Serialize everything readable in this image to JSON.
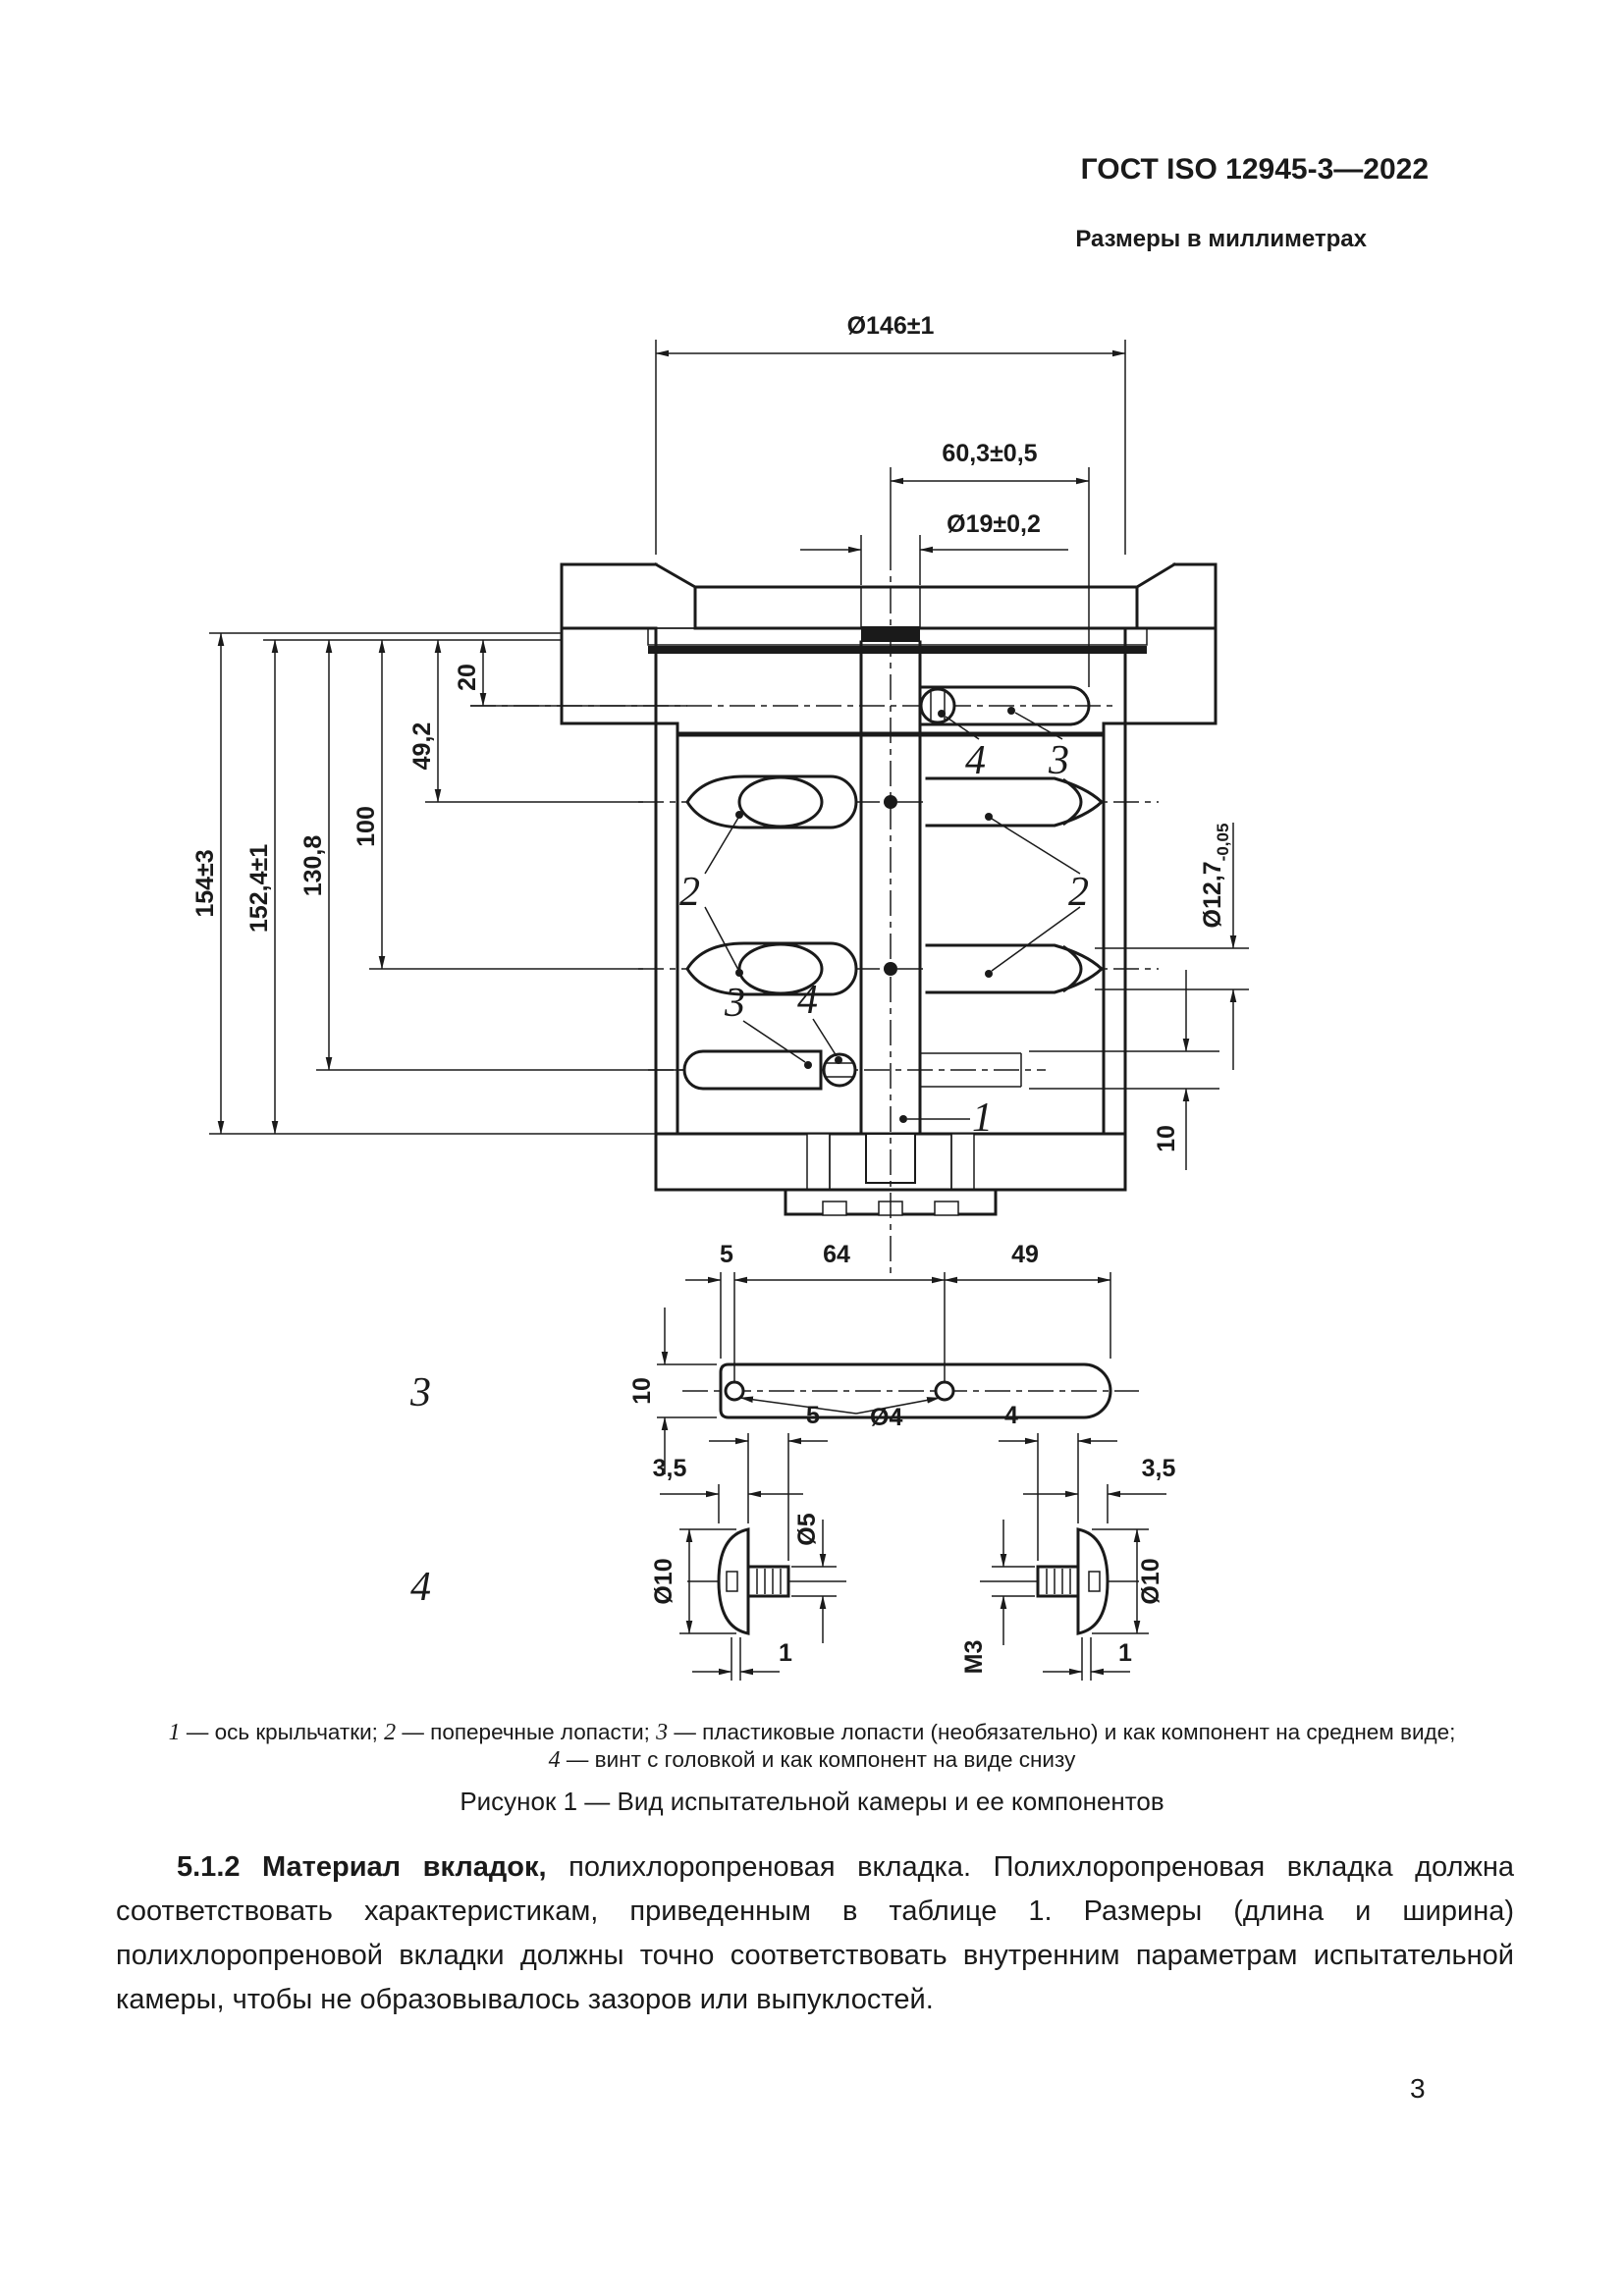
{
  "page": {
    "standard_code": "ГОСТ ISO 12945-3—2022",
    "units_note": "Размеры в миллиметрах",
    "page_number": "3"
  },
  "figure": {
    "caption": "Рисунок 1 — Вид испытательной камеры и ее компонентов",
    "legend": {
      "ref1": "1",
      "desc1": " — ось крыльчатки; ",
      "ref2": "2",
      "desc2": " — поперечные лопасти; ",
      "ref3": "3",
      "desc3": " — пластиковые лопасти (необязательно) и как компонент на среднем виде;",
      "ref4": "4",
      "desc4": " — винт с головкой и как компонент на виде снизу"
    },
    "main_view": {
      "dim_outer_diameter": "Ø146±1",
      "dim_blade_span": "60,3±0,5",
      "dim_shaft_hole": "Ø19±0,2",
      "dim_total_height": "154±3",
      "dim_inner_height": "152,4±1",
      "dim_lower_blade_height": "130,8",
      "dim_mid_blade_height": "100",
      "dim_upper_blade_height": "49,2",
      "dim_top_blade_offset": "20",
      "dim_shaft_dia": "Ø12,7",
      "dim_shaft_dia_tol": "-0,05",
      "dim_bottom_blade_dia": "10",
      "ref_axis": "1",
      "ref_cross_blade": "2",
      "ref_plastic_blade": "3",
      "ref_screw": "4"
    },
    "blade_view": {
      "label": "3",
      "dim_end_offset": "5",
      "dim_hole_spacing": "64",
      "dim_tip_length": "49",
      "dim_width": "10",
      "dim_hole_dia": "Ø4"
    },
    "screw_view": {
      "label": "4",
      "left": {
        "dim_shank_len": "5",
        "dim_head_h": "3,5",
        "dim_shank_dia": "Ø5",
        "dim_head_dia": "Ø10",
        "dim_tip": "1"
      },
      "right": {
        "dim_shank_len": "4",
        "dim_head_h": "3,5",
        "dim_head_dia": "Ø10",
        "dim_thread": "M3",
        "dim_tip": "1"
      }
    }
  },
  "body": {
    "clause_label": "5.1.2 Материал вкладок,",
    "clause_text": " полихлоропреновая вкладка. Полихлоропреновая вкладка должна соответствовать характеристикам, приведенным в таблице 1. Размеры (длина и ширина) полихлоропреновой вкладки должны точно соответствовать внутренним параметрам испытательной камеры, чтобы не образовывалось зазоров или выпуклостей."
  }
}
